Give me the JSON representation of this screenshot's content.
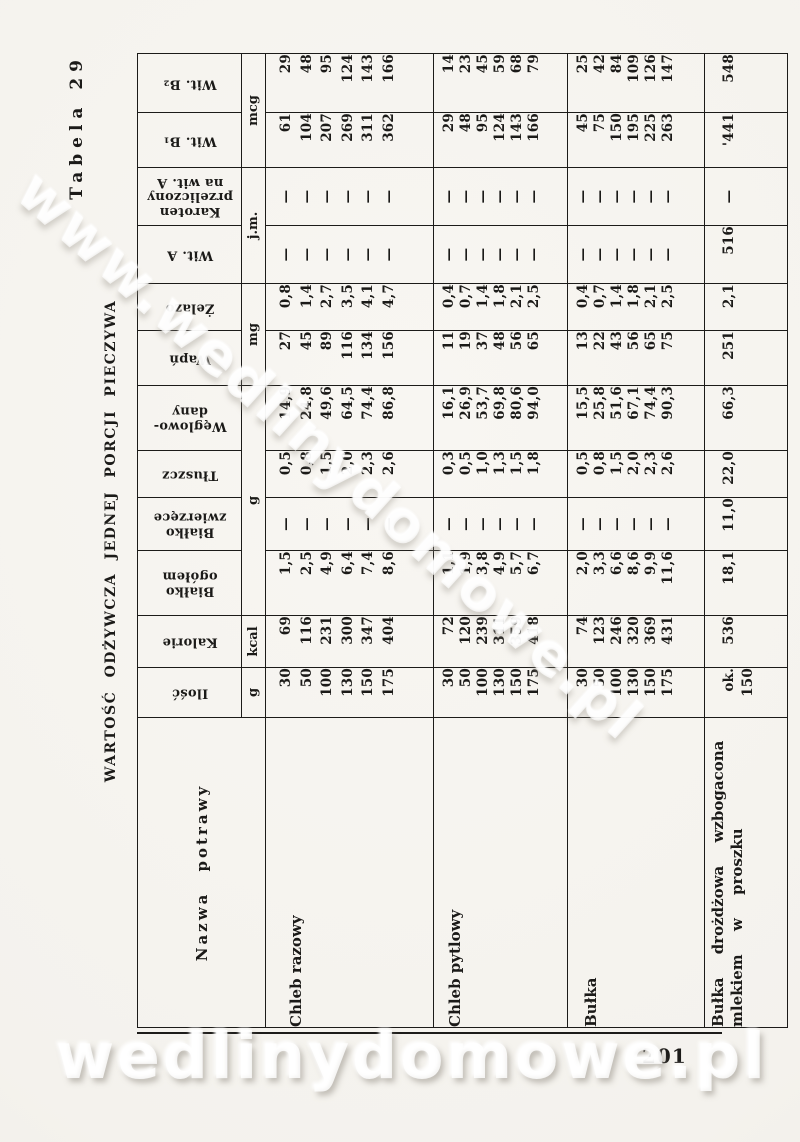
{
  "page": {
    "table_label": "Tabela 29",
    "title": "WARTOŚĆ ODŻYWCZA JEDNEJ PORCJI PIECZYWA",
    "number": "201"
  },
  "watermarks": {
    "diagonal": "www.wedlinydomowe.pl",
    "bottom": "wedlinydomowe.pl"
  },
  "table": {
    "headers": {
      "nazwa": "Nazwa potrawy",
      "ilosc": "Ilość",
      "kalorie": "Kalorie",
      "bialko_ogolem": "Białko\nogółem",
      "bialko_zwierzece": "Białko\nzwierzęce",
      "tluszcz": "Tłuszcz",
      "weglowodany": "Węglowo-\ndany",
      "wapn": "Wapń",
      "zelazo": "Żelazo",
      "wit_a": "Wit. A",
      "karoten": "Karoten\nprzeliczony\nna wit. A",
      "wit_b1": "Wit. B₁",
      "wit_b2": "Wit. B₂"
    },
    "units": {
      "ilosc": "g",
      "kalorie": "kcal",
      "bialko_weglowodany": "g",
      "wapn_zelazo": "mg",
      "wit_a_karoten": "j.m.",
      "wit_b": "mcg"
    },
    "groups": [
      {
        "name": "Chleb razowy",
        "ilosc": [
          "30",
          "50",
          "100",
          "130",
          "150",
          "175"
        ],
        "kalorie": [
          "69",
          "116",
          "231",
          "300",
          "347",
          "404"
        ],
        "bialko_ogolem": [
          "1,5",
          "2,5",
          "4,9",
          "6,4",
          "7,4",
          "8,6"
        ],
        "bialko_zwierzece": [
          "—",
          "—",
          "—",
          "—",
          "—",
          "—"
        ],
        "tluszcz": [
          "0,5",
          "0,8",
          "1,5",
          "2,0",
          "2,3",
          "2,6"
        ],
        "weglowodany": [
          "14,9",
          "24,8",
          "49,6",
          "64,5",
          "74,4",
          "86,8"
        ],
        "wapn": [
          "27",
          "45",
          "89",
          "116",
          "134",
          "156"
        ],
        "zelazo": [
          "0,8",
          "1,4",
          "2,7",
          "3,5",
          "4,1",
          "4,7"
        ],
        "wit_a": [
          "—",
          "—",
          "—",
          "—",
          "—",
          "—"
        ],
        "karoten": [
          "—",
          "—",
          "—",
          "—",
          "—",
          "—"
        ],
        "wit_b1": [
          "61",
          "104",
          "207",
          "269",
          "311",
          "362"
        ],
        "wit_b2": [
          "29",
          "48",
          "95",
          "124",
          "143",
          "166"
        ]
      },
      {
        "name": "Chleb pytlowy",
        "ilosc": [
          "30",
          "50",
          "100",
          "130",
          "150",
          "175"
        ],
        "kalorie": [
          "72",
          "120",
          "239",
          "311",
          "359",
          "418"
        ],
        "bialko_ogolem": [
          "1,1",
          "1,9",
          "3,8",
          "4,9",
          "5,7",
          "6,7"
        ],
        "bialko_zwierzece": [
          "—",
          "—",
          "—",
          "—",
          "—",
          "—"
        ],
        "tluszcz": [
          "0,3",
          "0,5",
          "1,0",
          "1,3",
          "1,5",
          "1,8"
        ],
        "weglowodany": [
          "16,1",
          "26,9",
          "53,7",
          "69,8",
          "80,6",
          "94,0"
        ],
        "wapn": [
          "11",
          "19",
          "37",
          "48",
          "56",
          "65"
        ],
        "zelazo": [
          "0,4",
          "0,7",
          "1,4",
          "1,8",
          "2,1",
          "2,5"
        ],
        "wit_a": [
          "—",
          "—",
          "—",
          "—",
          "—",
          "—"
        ],
        "karoten": [
          "—",
          "—",
          "—",
          "—",
          "—",
          "—"
        ],
        "wit_b1": [
          "29",
          "48",
          "95",
          "124",
          "143",
          "166"
        ],
        "wit_b2": [
          "14",
          "23",
          "45",
          "59",
          "68",
          "79"
        ]
      },
      {
        "name": "Bułka",
        "ilosc": [
          "30",
          "50",
          "100",
          "130",
          "150",
          "175"
        ],
        "kalorie": [
          "74",
          "123",
          "246",
          "320",
          "369",
          "431"
        ],
        "bialko_ogolem": [
          "2,0",
          "3,3",
          "6,6",
          "8,6",
          "9,9",
          "11,6"
        ],
        "bialko_zwierzece": [
          "—",
          "—",
          "—",
          "—",
          "—",
          "—"
        ],
        "tluszcz": [
          "0,5",
          "0,8",
          "1,5",
          "2,0",
          "2,3",
          "2,6"
        ],
        "weglowodany": [
          "15,5",
          "25,8",
          "51,6",
          "67,1",
          "74,4",
          "90,3"
        ],
        "wapn": [
          "13",
          "22",
          "43",
          "56",
          "65",
          "75"
        ],
        "zelazo": [
          "0,4",
          "0,7",
          "1,4",
          "1,8",
          "2,1",
          "2,5"
        ],
        "wit_a": [
          "—",
          "—",
          "—",
          "—",
          "—",
          "—"
        ],
        "karoten": [
          "—",
          "—",
          "—",
          "—",
          "—",
          "—"
        ],
        "wit_b1": [
          "45",
          "75",
          "150",
          "195",
          "225",
          "263"
        ],
        "wit_b2": [
          "25",
          "42",
          "84",
          "109",
          "126",
          "147"
        ]
      },
      {
        "name": "Bułka drożdżowa wzbogacona\nmlekiem w proszku",
        "ilosc": [
          "ok. 150"
        ],
        "kalorie": [
          "536"
        ],
        "bialko_ogolem": [
          "18,1"
        ],
        "bialko_zwierzece": [
          "11,0"
        ],
        "tluszcz": [
          "22,0"
        ],
        "weglowodany": [
          "66,3"
        ],
        "wapn": [
          "251"
        ],
        "zelazo": [
          "2,1"
        ],
        "wit_a": [
          "516"
        ],
        "karoten": [
          "—"
        ],
        "wit_b1": [
          "'441"
        ],
        "wit_b2": [
          "548"
        ]
      }
    ]
  }
}
